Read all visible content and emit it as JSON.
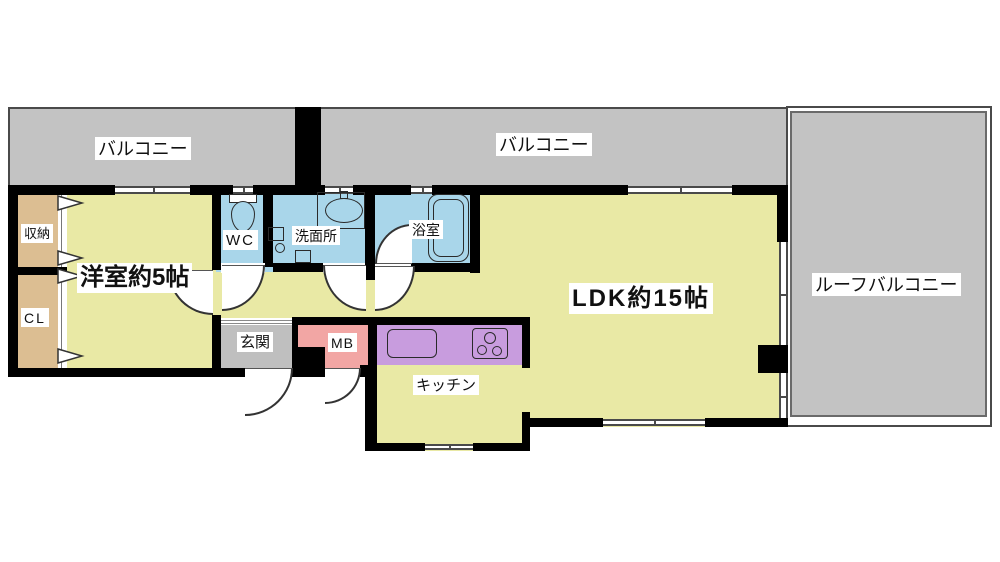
{
  "plan_title": "apartment floor plan",
  "rooms": {
    "balcony_left": {
      "label": "バルコニー"
    },
    "balcony_center": {
      "label": "バルコニー"
    },
    "roof_balcony": {
      "label": "ルーフバルコニー"
    },
    "storage": {
      "label": "収納"
    },
    "closet": {
      "label": "CL"
    },
    "western_room": {
      "label": "洋室約5帖"
    },
    "wc": {
      "label": "WC"
    },
    "washroom": {
      "label": "洗面所"
    },
    "bathroom": {
      "label": "浴室"
    },
    "ldk": {
      "label": "LDK約15帖"
    },
    "entrance": {
      "label": "玄関"
    },
    "meter_box": {
      "label": "MB"
    },
    "kitchen": {
      "label": "キッチン"
    }
  },
  "fixtures": {
    "toilet": "toilet-icon",
    "vanity_sink": "sink-icon",
    "washing_machine": "washing-machine-icon",
    "bathtub": "bathtub-icon",
    "kitchen_sink": "kitchen-sink-icon",
    "stove": "stove-icon",
    "closet_doors": "folding-door-triangles"
  },
  "colors": {
    "room_yellow": "#E9E9A5",
    "wet_blue": "#A9D6EA",
    "closet_tan": "#DCBE92",
    "counter_purple": "#C89CDE",
    "meter_box_pink": "#F2A6A4",
    "balcony_gray": "#C3C3C3",
    "entrance_gray": "#BFBFBF",
    "wall_black": "#000000"
  }
}
